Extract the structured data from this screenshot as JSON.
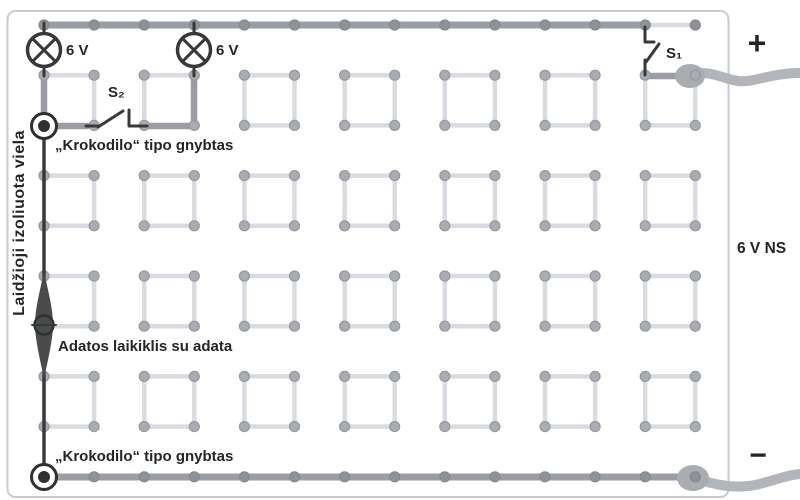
{
  "labels": {
    "lamp1": "6 V",
    "lamp2": "6 V",
    "switch1": "S₁",
    "switch2": "S₂",
    "clip_top": "„Krokodilo“ tipo gnybtas",
    "needle_holder": "Adatos laikiklis su adata",
    "clip_bottom": "„Krokodilo“ tipo gnybtas",
    "insulated_wire": "Laidžioji izoliuota viela",
    "plus_terminal": "+",
    "minus_terminal": "−",
    "power_supply": "6 V NS"
  },
  "grid": {
    "columns": 14,
    "rows": 10,
    "x_start": 44,
    "y_start": 25,
    "x_step": 50.1,
    "y_step": 50.2,
    "square_col_starts": [
      0,
      2,
      4,
      6,
      8,
      10,
      12
    ],
    "square_row_starts": [
      1,
      3,
      5,
      7
    ],
    "rail_rows": [
      0,
      9
    ],
    "peg_radius": 5
  },
  "colors": {
    "dark": "#37383a",
    "text": "#242527",
    "wire": "#9a9da1",
    "link": "#d8dbdf",
    "peg": "#a9acb0",
    "pegDark": "#8f9296",
    "lead": "#b2b5b9",
    "border": "#c7cbce",
    "spindle": "#4a4b4d"
  }
}
